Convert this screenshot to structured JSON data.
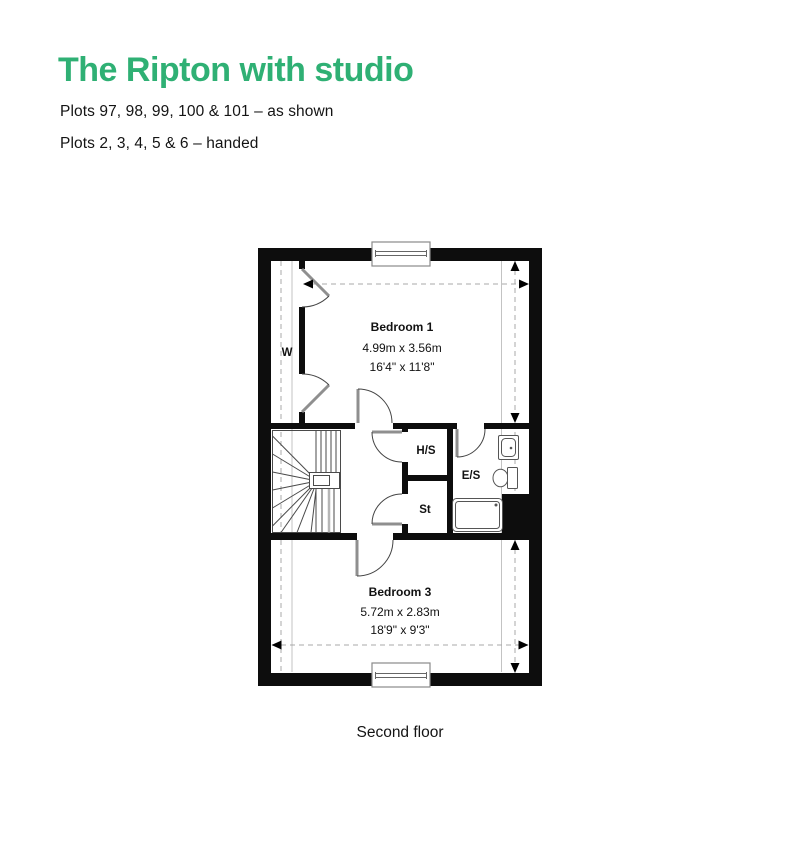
{
  "header": {
    "title": "The Ripton with studio",
    "subtitle_line1": "Plots 97, 98, 99, 100 & 101 – as shown",
    "subtitle_line2": "Plots 2, 3, 4, 5 & 6 – handed"
  },
  "colors": {
    "accent_green": "#2fb074",
    "wall_black": "#0d0d0d",
    "text": "#1a1a1a"
  },
  "floorplan": {
    "caption": "Second floor",
    "rooms": [
      {
        "id": "bedroom-1",
        "name": "Bedroom 1",
        "size_metric": "4.99m x 3.56m",
        "size_imperial": "16'4\" x 11'8\""
      },
      {
        "id": "bedroom-3",
        "name": "Bedroom 3",
        "size_metric": "5.72m x 2.83m",
        "size_imperial": "18'9\" x 9'3\""
      }
    ],
    "small_labels": {
      "wardrobe": "W",
      "heating_store": "H/S",
      "ensuite": "E/S",
      "store": "St"
    }
  }
}
